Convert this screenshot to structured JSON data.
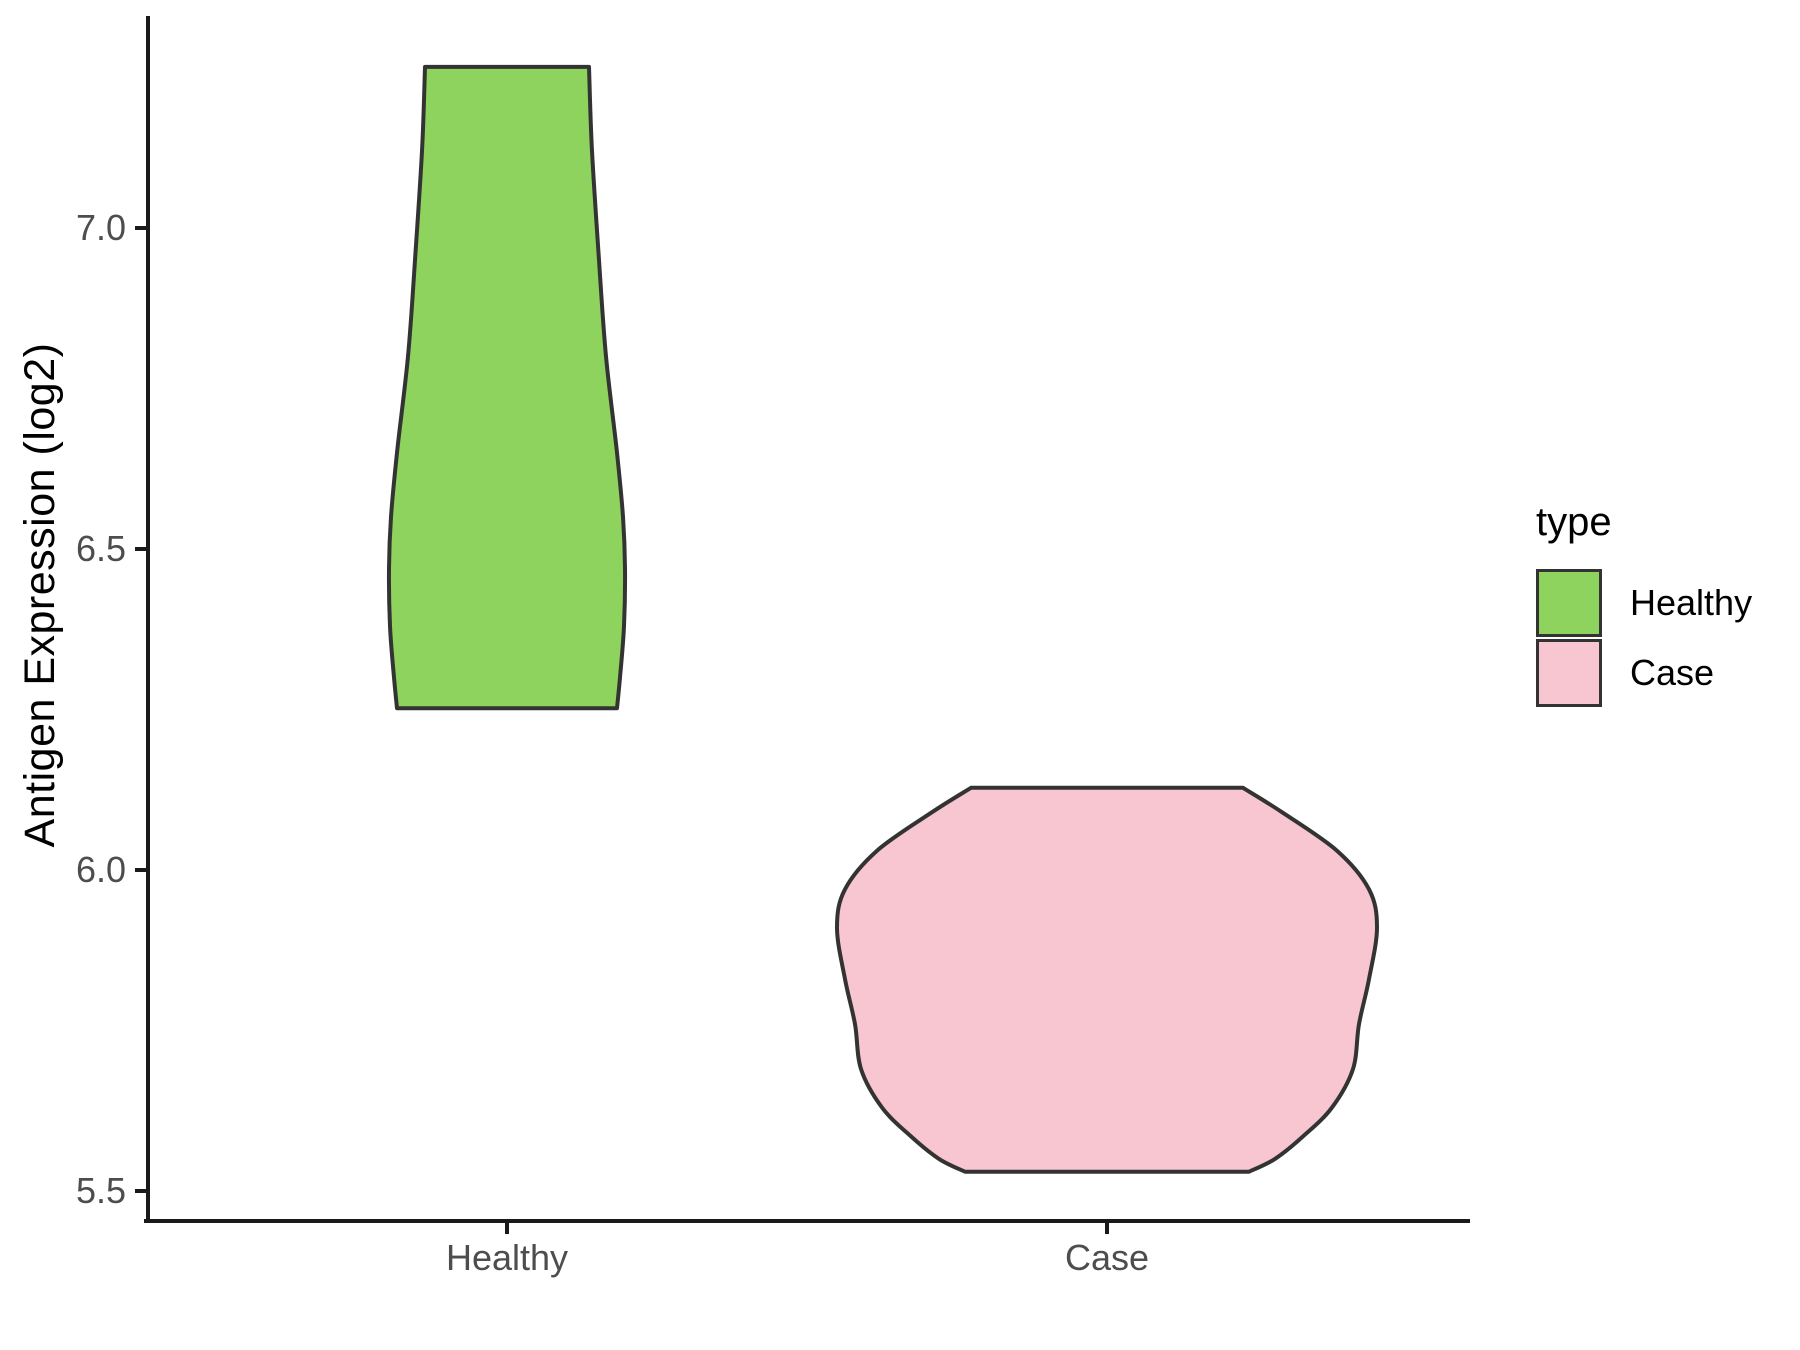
{
  "chart_data": {
    "type": "violin",
    "title": "",
    "xlabel": "",
    "ylabel": "Antigen Expression (log2)",
    "ylim": [
      5.45,
      7.3
    ],
    "grid": "off",
    "legend_position": "right",
    "legend_title": "type",
    "categories": [
      "Healthy",
      "Case"
    ],
    "y_ticks": [
      {
        "label": "7.0",
        "value": 7.0
      },
      {
        "label": "6.5",
        "value": 6.5
      },
      {
        "label": "6.0",
        "value": 6.0
      },
      {
        "label": "5.5",
        "value": 5.5
      }
    ],
    "series": [
      {
        "name": "Healthy",
        "fill_color": "#8FD35F",
        "value_range": [
          6.25,
          7.25
        ],
        "profile": [
          {
            "v": 7.251,
            "hw": 82
          },
          {
            "v": 7.12,
            "hw": 85
          },
          {
            "v": 6.95,
            "hw": 92
          },
          {
            "v": 6.8,
            "hw": 99
          },
          {
            "v": 6.65,
            "hw": 110
          },
          {
            "v": 6.55,
            "hw": 116
          },
          {
            "v": 6.47,
            "hw": 118
          },
          {
            "v": 6.38,
            "hw": 117
          },
          {
            "v": 6.3,
            "hw": 113
          },
          {
            "v": 6.252,
            "hw": 110
          }
        ]
      },
      {
        "name": "Case",
        "fill_color": "#F8C6D1",
        "value_range": [
          5.53,
          6.13
        ],
        "profile": [
          {
            "v": 6.128,
            "hw": 136
          },
          {
            "v": 6.09,
            "hw": 175
          },
          {
            "v": 6.03,
            "hw": 230
          },
          {
            "v": 5.97,
            "hw": 262
          },
          {
            "v": 5.91,
            "hw": 270
          },
          {
            "v": 5.83,
            "hw": 262
          },
          {
            "v": 5.76,
            "hw": 252
          },
          {
            "v": 5.69,
            "hw": 246
          },
          {
            "v": 5.63,
            "hw": 225
          },
          {
            "v": 5.585,
            "hw": 196
          },
          {
            "v": 5.55,
            "hw": 168
          },
          {
            "v": 5.53,
            "hw": 142
          }
        ]
      }
    ],
    "outline_color": "#333333",
    "axis_color": "#1a1a1a",
    "tick_label_color": "#4d4d4d",
    "legend": {
      "title": "type",
      "items": [
        {
          "label": "Healthy",
          "color": "#8FD35F"
        },
        {
          "label": "Case",
          "color": "#F8C6D1"
        }
      ]
    }
  }
}
